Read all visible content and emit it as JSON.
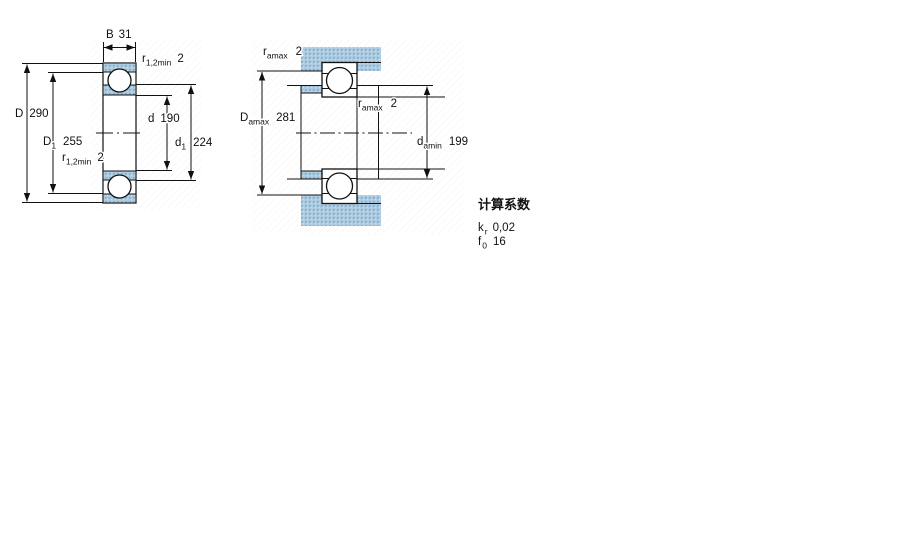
{
  "colors": {
    "hatch_base": "#adcce2",
    "hatch_dot": "#7fa8c6",
    "line": "#1a1a1a",
    "background": "#ffffff"
  },
  "left_figure": {
    "width_dim": {
      "symbol": "B",
      "value": "31"
    },
    "outer_dia": {
      "symbol": "D",
      "value": "290"
    },
    "recess_dia": {
      "symbol": "D",
      "sub": "1",
      "value": "255"
    },
    "bore_dia": {
      "symbol": "d",
      "value": "190"
    },
    "shoulder_dia": {
      "symbol": "d",
      "sub": "1",
      "value": "224"
    },
    "chamfer_top": {
      "symbol": "r",
      "sub": "1,2min",
      "value": "2"
    },
    "chamfer_bottom": {
      "symbol": "r",
      "sub": "1,2min",
      "value": "2"
    }
  },
  "right_figure": {
    "housing_fillet": {
      "symbol": "r",
      "sub": "amax",
      "value": "2"
    },
    "shaft_fillet": {
      "symbol": "r",
      "sub": "amax",
      "value": "2"
    },
    "housing_abutment_dia": {
      "symbol": "D",
      "sub": "amax",
      "value": "281"
    },
    "shaft_abutment_dia": {
      "symbol": "d",
      "sub": "amin",
      "value": "199"
    }
  },
  "calculation_factors": {
    "title": "计算系数",
    "rows": [
      {
        "symbol": "k",
        "sub": "r",
        "value": "0,02"
      },
      {
        "symbol": "f",
        "sub": "0",
        "value": "16"
      }
    ]
  }
}
